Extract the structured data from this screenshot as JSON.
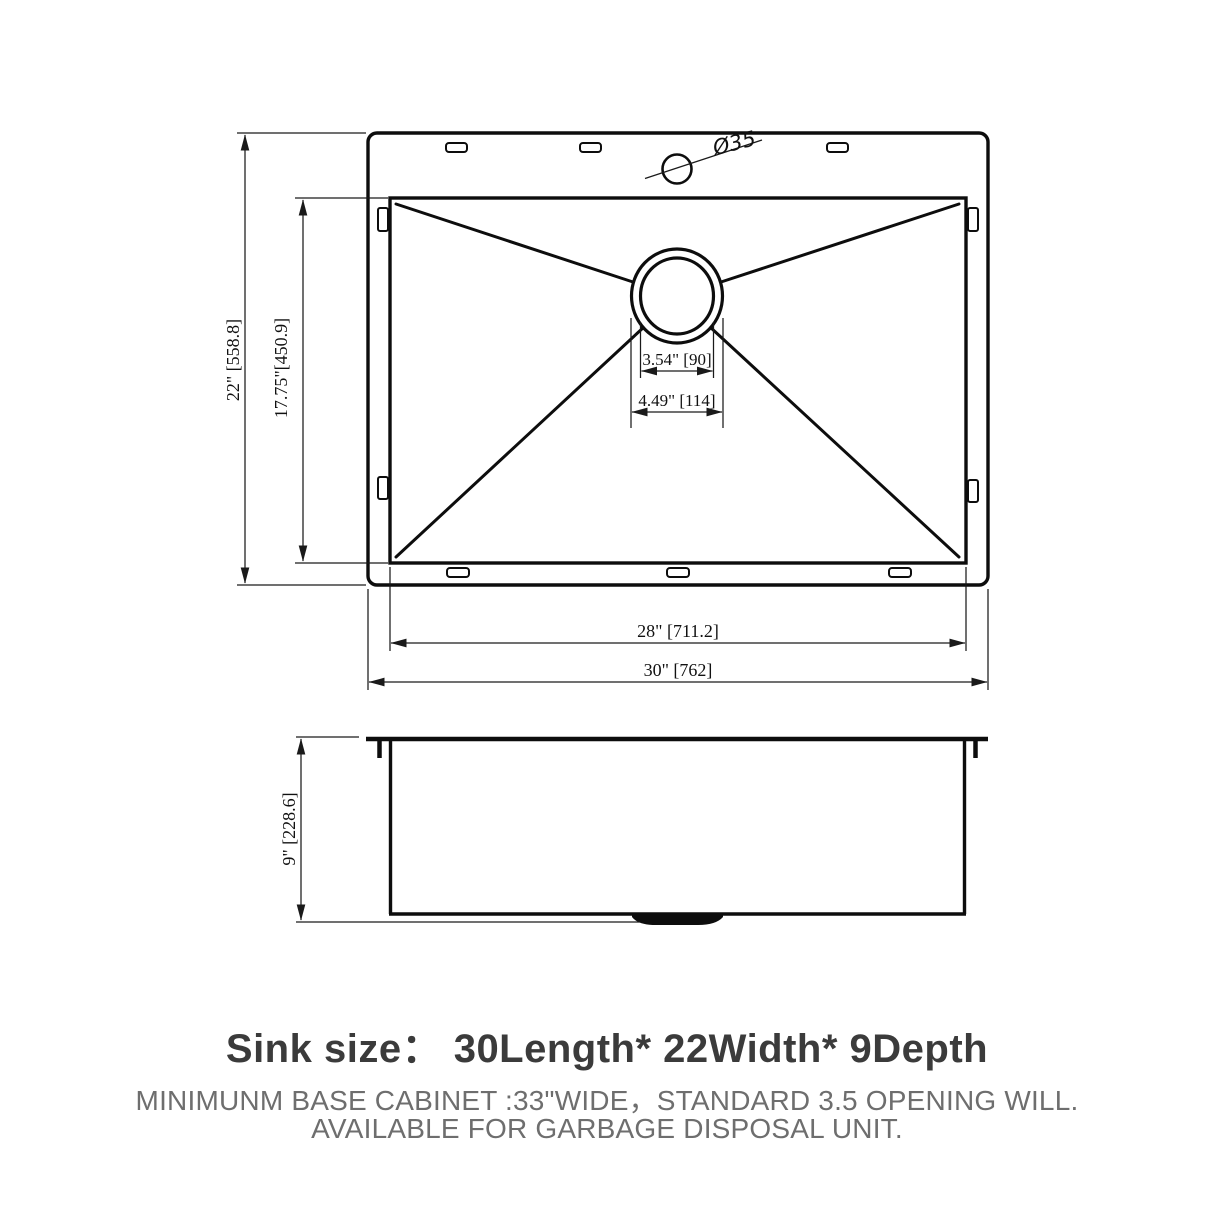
{
  "colors": {
    "line": "#0d0d0d",
    "title_text": "#3b3b3b",
    "body_text": "#6e6e6e",
    "background": "#ffffff"
  },
  "top_view": {
    "faucet_hole_label": "Ø35",
    "dim_overall_width": "22\" [558.8]",
    "dim_basin_width": "17.75\"[450.9]",
    "dim_drain_inner": "3.54\" [90]",
    "dim_drain_outer": "4.49\" [114]",
    "dim_basin_length": "28\" [711.2]",
    "dim_overall_length": "30\" [762]"
  },
  "side_view": {
    "dim_depth": "9\" [228.6]"
  },
  "caption": {
    "title": "Sink size： 30Length* 22Width* 9Depth",
    "line2": "MINIMUNM BASE CABINET :33\"WIDE，STANDARD 3.5 OPENING WILL.",
    "line3": "AVAILABLE FOR GARBAGE DISPOSAL UNIT."
  }
}
